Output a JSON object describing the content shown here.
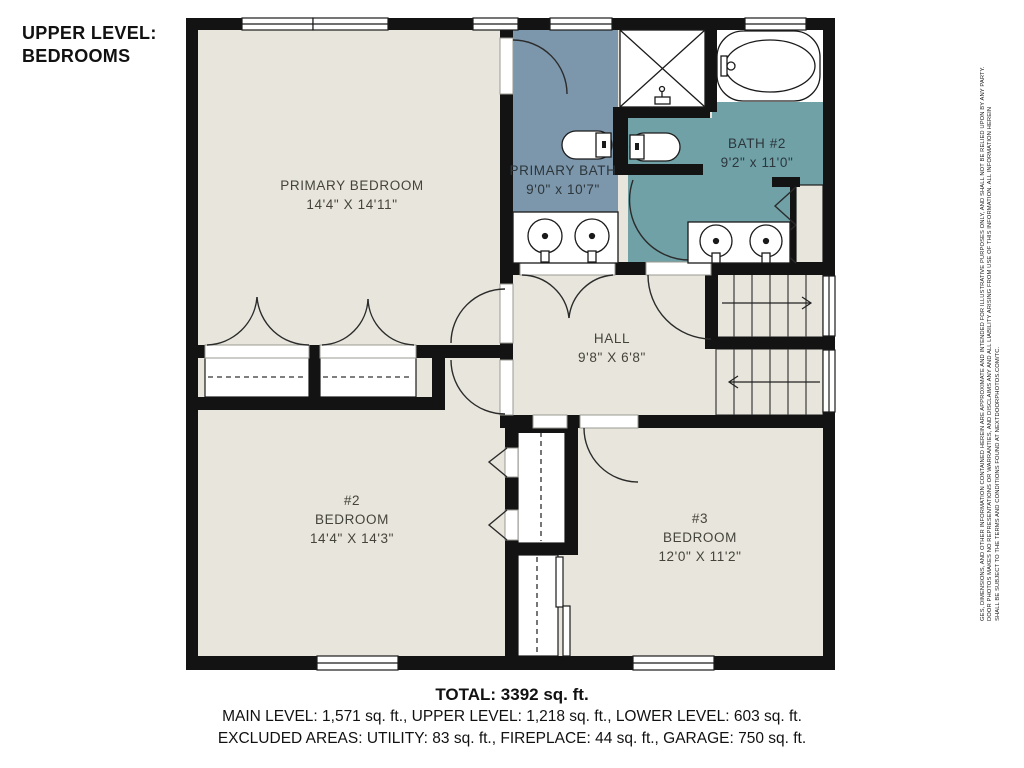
{
  "title": {
    "line1": "UPPER LEVEL:",
    "line2": "BEDROOMS"
  },
  "rooms": {
    "primary_bedroom": {
      "name": "PRIMARY BEDROOM",
      "dims": "14'4\" X 14'11\""
    },
    "primary_bath": {
      "name": "PRIMARY BATH",
      "dims": "9'0\" x 10'7\""
    },
    "bath2": {
      "name": "BATH #2",
      "dims": "9'2\" x 11'0\""
    },
    "hall": {
      "name": "HALL",
      "dims": "9'8\" X 6'8\""
    },
    "bedroom2": {
      "number": "#2",
      "name": "BEDROOM",
      "dims": "14'4\" X 14'3\""
    },
    "bedroom3": {
      "number": "#3",
      "name": "BEDROOM",
      "dims": "12'0\" X 11'2\""
    }
  },
  "footer": {
    "total": "TOTAL: 3392 sq. ft.",
    "levels": "MAIN LEVEL: 1,571 sq. ft., UPPER LEVEL: 1,218 sq. ft., LOWER LEVEL: 603 sq. ft.",
    "excluded": "EXCLUDED AREAS: UTILITY: 83 sq. ft., FIREPLACE: 44 sq. ft., GARAGE: 750 sq. ft."
  },
  "disclaimer": {
    "line1": "GES, DIMENSIONS, AND OTHER INFORMATION CONTAINED HEREIN ARE APPROXIMATE AND INTENDED FOR ILLUSTRATIVE PURPOSES ONLY, AND SHALL NOT BE RELIED UPON BY ANY PARTY.",
    "line2": "DOOR PHOTOS MAKES NO REPRESENTATIONS OR WARRANTIES, AND DISCLAIMS ANY AND ALL LIABILITY ARISING FROM USE OF THIS INFORMATION. ALL INFORMATION HEREIN",
    "line3": "SHALL BE SUBJECT TO THE TERMS AND CONDITIONS FOUND AT NEXTDOORPHOTOS.COM/TC."
  },
  "colors": {
    "primary_bath": "#7C96AB",
    "bath2": "#6FA1A7",
    "floor": "#E8E6DC",
    "wall": "#131313",
    "fixture_white": "#FFFFFF"
  }
}
